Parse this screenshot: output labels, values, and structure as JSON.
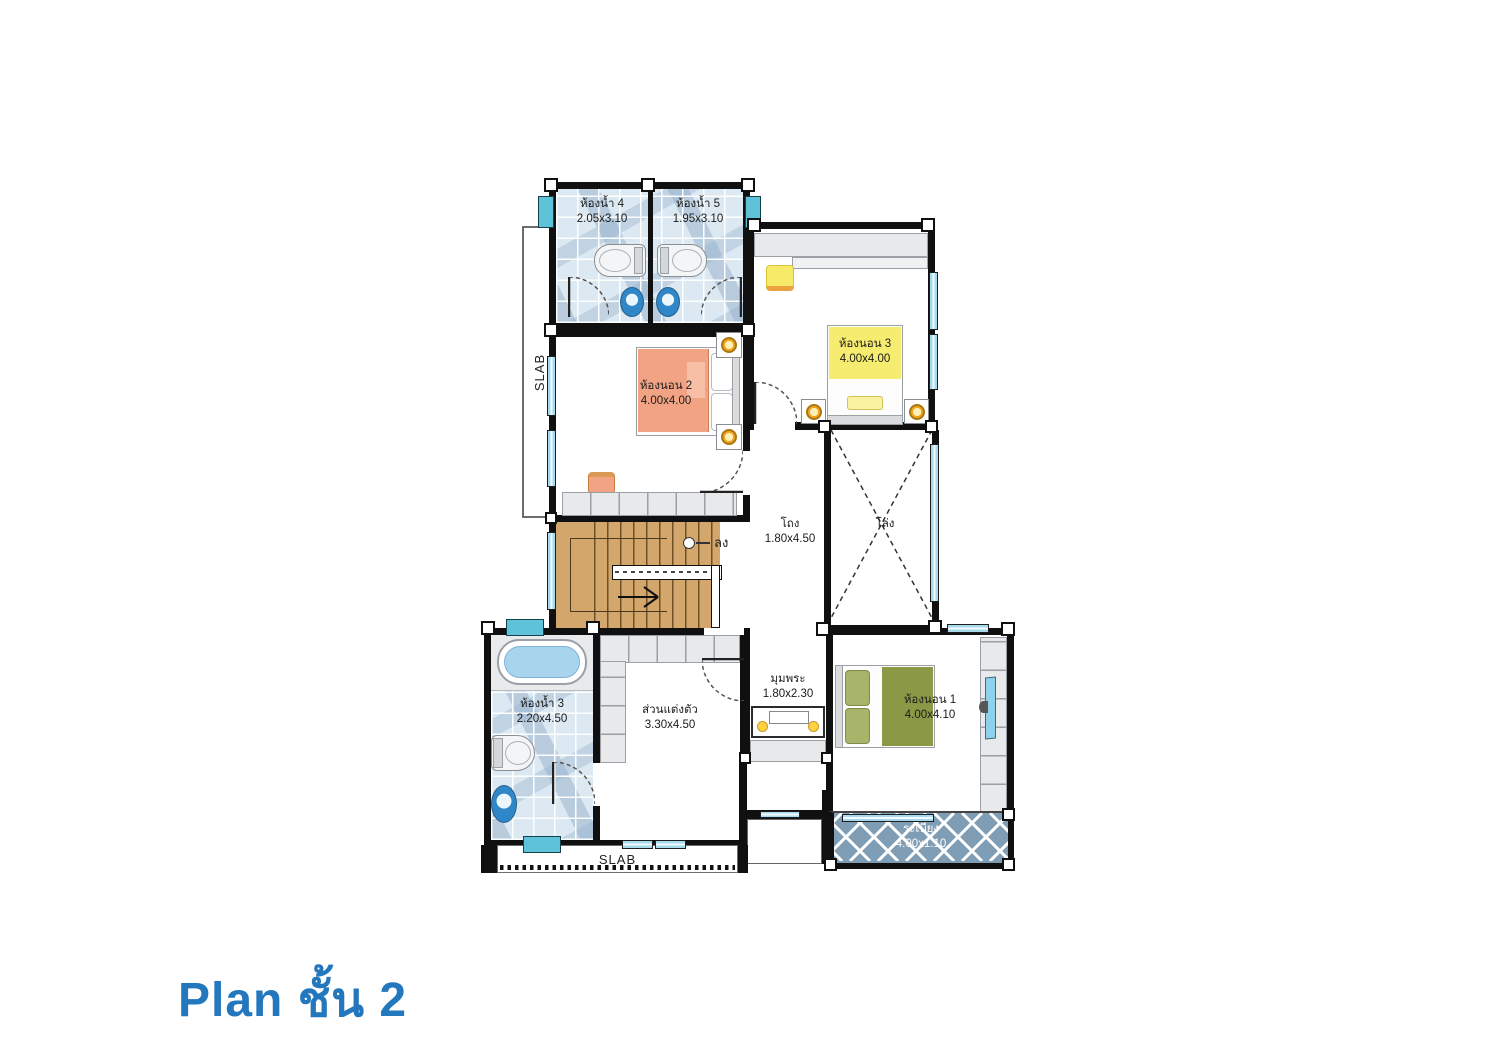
{
  "title": "Plan ชั้น 2",
  "slab": {
    "left": "SLAB",
    "bottom": "SLAB"
  },
  "stairs": {
    "down_label": "ลง"
  },
  "rooms": {
    "bath4": {
      "name": "ห้องน้ำ 4",
      "dim": "2.05x3.10"
    },
    "bath5": {
      "name": "ห้องน้ำ 5",
      "dim": "1.95x3.10"
    },
    "bed2": {
      "name": "ห้องนอน 2",
      "dim": "4.00x4.00"
    },
    "bed3": {
      "name": "ห้องนอน 3",
      "dim": "4.00x4.00"
    },
    "hall": {
      "name": "โถง",
      "dim": "1.80x4.50"
    },
    "void": {
      "name": "โล่ง",
      "dim": ""
    },
    "bath3": {
      "name": "ห้องน้ำ 3",
      "dim": "2.20x4.50"
    },
    "dressing": {
      "name": "ส่วนแต่งตัว",
      "dim": "3.30x4.50"
    },
    "buddha": {
      "name": "มุมพระ",
      "dim": "1.80x2.30"
    },
    "bed1": {
      "name": "ห้องนอน 1",
      "dim": "4.00x4.10"
    },
    "balcony": {
      "name": "ระเบียง",
      "dim": "4.00x1.10"
    }
  },
  "colors": {
    "title_blue": "#2277bd",
    "bed_orange": "#f1a384",
    "bed_green": "#8b9947",
    "highlight_yellow": "#f6ec70",
    "balcony_blue": "#7f9db5",
    "window_blue": "#a6d9ec",
    "stair_wood": "#d3a76c"
  }
}
